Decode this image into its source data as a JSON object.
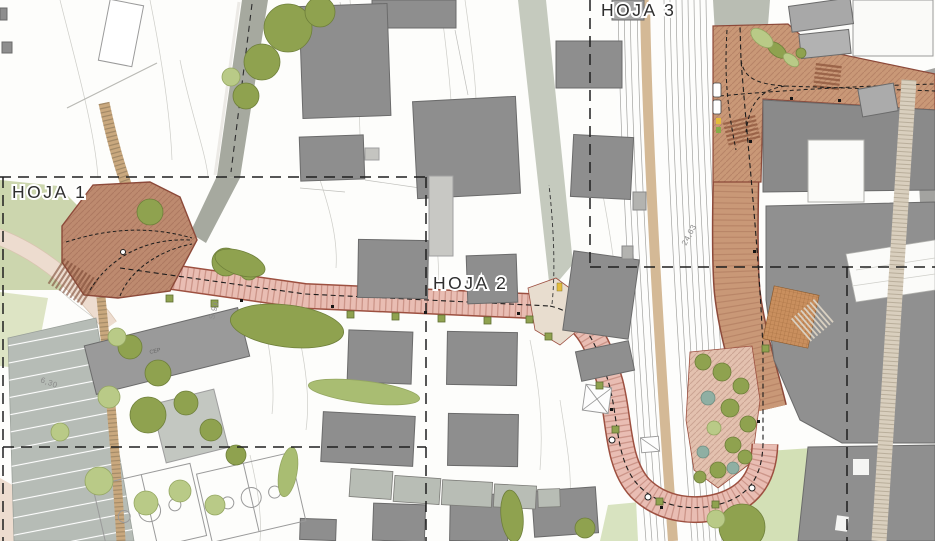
{
  "map": {
    "type": "urban-plan-site-map",
    "sheets": [
      {
        "id": "hoja-1",
        "label": "HOJA 1"
      },
      {
        "id": "hoja-2",
        "label": "HOJA 2"
      },
      {
        "id": "hoja-3",
        "label": "HOJA 3"
      }
    ],
    "annotations": {
      "track_dimension": "24,63",
      "section_label": "S 90",
      "width_dimension": "6,30",
      "school_label": "CEP"
    },
    "colors": {
      "corridor_pink": "#e9bdb3",
      "corridor_border": "#9d5040",
      "plaza_tan": "#c99877",
      "plaza_brown": "#bd8a6f",
      "building_gray": "#8e8e8e",
      "tree_olive": "#8fa24f",
      "tree_light": "#b9ca87",
      "grass_pale": "#ccd6ae",
      "road_gray": "#a6a99f",
      "path_tan": "#c9a87e",
      "boundary_dash": "#1f1f1f",
      "marker_yellow": "#e4bc3c"
    }
  }
}
